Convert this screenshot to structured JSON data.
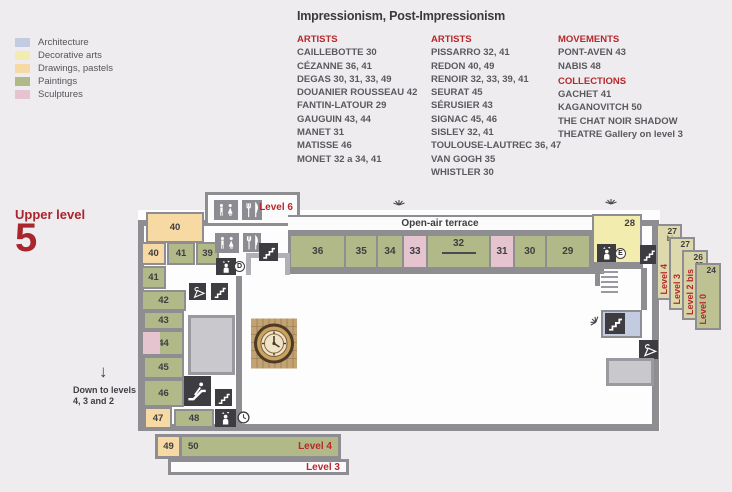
{
  "palette": {
    "accent_red": "#b5282c",
    "wall_gray": "#8e8d92",
    "icon_dark": "#3d3c41",
    "icon_gray": "#8d8c92",
    "architecture": "#c2cbdf",
    "decorative_arts": "#f2ecae",
    "drawings_pastels": "#f7d9a3",
    "paintings": "#b2b988",
    "sculptures": "#e5c3cf",
    "room_gray": "#c9c8cd",
    "card_khaki": "#d9d5a8",
    "page_bg": "#eeecee"
  },
  "header": {
    "title": "Impressionism, Post-Impressionism",
    "legend": [
      {
        "label": "Architecture",
        "color": "#c2cbdf"
      },
      {
        "label": "Decorative arts",
        "color": "#f2ecae"
      },
      {
        "label": "Drawings, pastels",
        "color": "#f7d9a3"
      },
      {
        "label": "Paintings",
        "color": "#b2b988"
      },
      {
        "label": "Sculptures",
        "color": "#e5c3cf"
      }
    ],
    "artist_columns": [
      {
        "header": "ARTISTS",
        "items": [
          "CAILLEBOTTE 30",
          "CÉZANNE 36, 41",
          "DEGAS 30, 31, 33, 49",
          "DOUANIER ROUSSEAU 42",
          "FANTIN-LATOUR 29",
          "GAUGUIN 43, 44",
          "MANET 31",
          "MATISSE 46",
          "MONET 32 a 34, 41"
        ]
      },
      {
        "header": "ARTISTS",
        "items": [
          "PISSARRO 32, 41",
          "REDON 40, 49",
          "RENOIR 32, 33, 39, 41",
          "SEURAT 45",
          "SÉRUSIER 43",
          "SIGNAC 45, 46",
          "SISLEY 32, 41",
          "TOULOUSE-LAUTREC 36, 47",
          "VAN GOGH 35",
          "WHISTLER 30"
        ]
      }
    ],
    "info_column": {
      "sections": [
        {
          "header": "MOVEMENTS",
          "items": [
            "PONT-AVEN 43",
            "NABIS 48"
          ]
        },
        {
          "header": "COLLECTIONS",
          "items": [
            "GACHET 41",
            "KAGANOVITCH 50",
            "THE CHAT NOIR SHADOW",
            "THEATRE Gallery on level 3"
          ]
        }
      ]
    }
  },
  "plan": {
    "level_label": "Upper level",
    "level_number": "5",
    "level6_label": "Level 6",
    "terrace_label": "Open-air terrace",
    "down_note_line1": "Down to levels",
    "down_note_line2": "4, 3 and 2",
    "down_arrow": "↓",
    "elevators": {
      "d": "D",
      "e": "E"
    },
    "rooms": {
      "r40big": "40",
      "r40": "40",
      "r41": "41",
      "r39": "39",
      "r41b": "41",
      "r42": "42",
      "r43": "43",
      "r44": "44",
      "r45": "45",
      "r46": "46",
      "r47": "47",
      "r48": "48",
      "r49": "49",
      "r50": "50",
      "g36": "36",
      "g35": "35",
      "g34": "34",
      "g33": "33",
      "g32": "32",
      "g31": "31",
      "g30": "30",
      "g29": "29",
      "r28": "28"
    },
    "cascade": [
      {
        "room": "27",
        "room_sub": "bis",
        "label": "Level 4"
      },
      {
        "room": "27",
        "label": "Level 3"
      },
      {
        "room": "26",
        "room2": "25",
        "label": "Level 2 bis"
      },
      {
        "room": "24",
        "label": "Level 0"
      }
    ],
    "bars": [
      {
        "label": "Level 4"
      },
      {
        "label": "Level 3"
      }
    ]
  },
  "icons": {
    "restroom-icon": "male and female figures",
    "restaurant-icon": "fork and knife",
    "stairs-icon": "staircase steps",
    "elevator-icon": "person in lift with arrows",
    "escalator-icon": "person on escalator",
    "cloakroom-icon": "coat hanger",
    "clock-icon": "clock face",
    "viewpoint-icon": "ray burst",
    "grand-clock": "ornate museum clock face",
    "down-arrow-icon": "↓"
  }
}
